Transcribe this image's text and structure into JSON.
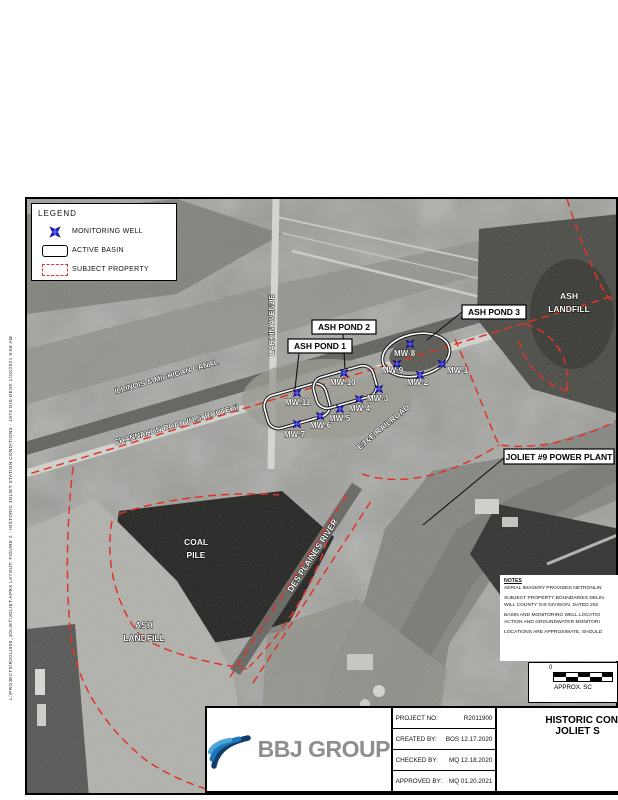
{
  "stamp": {
    "text": "L:\\PROJECTS\\R2011900_JOLIET\\JOLIET.APRX   LAYOUT: FIGURE 2 - HISTORIC JOLIET STATION CONDITIONS - 1973   GIS-DESK 1/20/2021 9:58 AM"
  },
  "legend": {
    "title": "LEGEND",
    "items": [
      {
        "symbol": "monitoring-well-icon",
        "label": "MONITORING WELL"
      },
      {
        "symbol": "active-basin-icon",
        "label": "ACTIVE BASIN"
      },
      {
        "symbol": "subject-property-icon",
        "label": "SUBJECT PROPERTY"
      }
    ]
  },
  "map": {
    "boxed_labels": [
      {
        "text": "ASH POND 1"
      },
      {
        "text": "ASH POND 2"
      },
      {
        "text": "ASH POND 3"
      },
      {
        "text": "JOLIET #9 POWER PLANT"
      }
    ],
    "area_labels": {
      "ash_landfill_ne": [
        "ASH",
        "LANDFILL"
      ],
      "ash_landfill_sw": [
        "ASH",
        "LANDFILL"
      ],
      "coal_pile": [
        "COAL",
        "PILE"
      ]
    },
    "road_labels": {
      "canal": "ILLINOIS & MICHIGAN CANAL",
      "channahon": "CHANNAHON ROAD (U.S. ROUTE 6)",
      "larkin": "LARKIN AVENUE",
      "railroad": "EJ&E RAILROAD",
      "river": "DES PLAINES RIVER"
    },
    "wells": [
      {
        "id": "MW-1",
        "x": 415,
        "y": 165,
        "label_x": 420,
        "label_y": 174
      },
      {
        "id": "MW-2",
        "x": 393,
        "y": 176,
        "label_x": 380,
        "label_y": 186
      },
      {
        "id": "MW-3",
        "x": 352,
        "y": 190,
        "label_x": 340,
        "label_y": 202
      },
      {
        "id": "MW-4",
        "x": 332,
        "y": 200,
        "label_x": 322,
        "label_y": 212
      },
      {
        "id": "MW-5",
        "x": 313,
        "y": 210,
        "label_x": 302,
        "label_y": 222
      },
      {
        "id": "MW-6",
        "x": 293,
        "y": 217,
        "label_x": 283,
        "label_y": 229
      },
      {
        "id": "MW-7",
        "x": 270,
        "y": 225,
        "label_x": 257,
        "label_y": 238
      },
      {
        "id": "MW-8",
        "x": 383,
        "y": 145,
        "label_x": 367,
        "label_y": 157
      },
      {
        "id": "MW-9",
        "x": 370,
        "y": 165,
        "label_x": 355,
        "label_y": 174
      },
      {
        "id": "MW-10",
        "x": 317,
        "y": 174,
        "label_x": 303,
        "label_y": 186
      },
      {
        "id": "MW-11",
        "x": 270,
        "y": 194,
        "label_x": 258,
        "label_y": 206
      }
    ]
  },
  "notes": {
    "title": "NOTES",
    "lines": [
      "AERIAL IMAGERY PROVIDED NETRONLIN",
      "SUBJECT PROPERTY BOUNDARIES DELIN",
      "WILL COUNTY GIS DIVISION, DATED 202",
      "BASIN AND MONITORING WELL LOCATIO",
      "ACTION AND GROUNDWATER MONITORI",
      "LOCATIONS ARE APPROXIMATE, SHOULD"
    ]
  },
  "scalebar": {
    "zero_label": "0",
    "caption": "APPROX. SC"
  },
  "titleblock": {
    "logo_text": "BBJ GROUP",
    "rows": [
      {
        "label": "PROJECT NO:",
        "value": "R2011900"
      },
      {
        "label": "CREATED BY:",
        "value": "BOS 12.17.2020"
      },
      {
        "label": "CHECKED BY:",
        "value": "MQ 12.18.2020"
      },
      {
        "label": "APPROVED BY:",
        "value": "MQ 01.20.2021"
      }
    ],
    "title_line1": "HISTORIC CON",
    "title_line2": "JOLIET S"
  },
  "colors": {
    "boundary_red": "#e03428",
    "well_blue": "#1f1fd6",
    "logo_blue_dark": "#143d6b",
    "logo_blue_mid": "#1d76b6",
    "logo_blue_light": "#4aa5d8",
    "logo_text_gray": "#8e8e8e"
  }
}
